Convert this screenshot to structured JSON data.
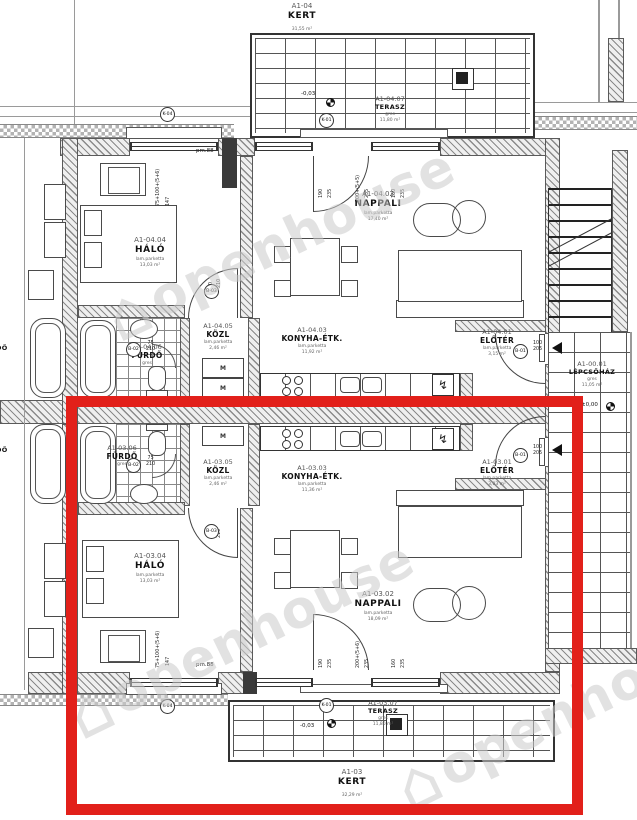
{
  "colors": {
    "highlight": "#e2201a"
  },
  "watermark": {
    "text": "openhouse",
    "logo": "⌂"
  },
  "stairwell": {
    "code": "A1-00.01",
    "name": "LÉPCSŐHÁZ",
    "finish": "gres",
    "area": "11,05 m²",
    "level": "±0,00"
  },
  "apt_top": {
    "garden": {
      "code": "A1-04",
      "name": "KERT",
      "area": "31,55 m²"
    },
    "terrace": {
      "code": "A1-04.07",
      "name": "TERASZ",
      "finish": "gres",
      "area": "11,80 m²"
    },
    "eloter": {
      "code": "A1-04.01",
      "name": "ELŐTÉR",
      "finish": "lam.parketta",
      "area": "3,15 m²"
    },
    "nappali": {
      "code": "A1-04.02",
      "name": "NAPPALI",
      "finish": "lam.parketta",
      "area": "17,40 m²"
    },
    "konyha": {
      "code": "A1-04.03",
      "name": "KONYHA-ÉTK.",
      "finish": "lam.parketta",
      "area": "11,92 m²"
    },
    "halo": {
      "code": "A1-04.04",
      "name": "HÁLÓ",
      "finish": "lam.parketta",
      "area": "13,03 m²"
    },
    "kozl": {
      "code": "A1-04.05",
      "name": "KÖZL",
      "finish": "lam.parketta",
      "area": "2,46 m²"
    },
    "furdo": {
      "code": "A1-04.06",
      "name": "FÜRDŐ",
      "finish": "gres",
      "area": "4,29 m²"
    }
  },
  "apt_bottom": {
    "garden": {
      "code": "A1-03",
      "name": "KERT",
      "area": "32,29 m²"
    },
    "terrace": {
      "code": "A1-03.07",
      "name": "TERASZ",
      "finish": "gres",
      "area": "11,80 m²"
    },
    "eloter": {
      "code": "A1-03.01",
      "name": "ELŐTÉR",
      "finish": "lam.parketta",
      "area": "3,03 m²"
    },
    "nappali": {
      "code": "A1-03.02",
      "name": "NAPPALI",
      "finish": "lam.parketta",
      "area": "18,09 m²"
    },
    "konyha": {
      "code": "A1-03.03",
      "name": "KONYHA-ÉTK.",
      "finish": "lam.parketta",
      "area": "11,36 m²"
    },
    "halo": {
      "code": "A1-03.04",
      "name": "HÁLÓ",
      "finish": "lam.parketta",
      "area": "13,03 m²"
    },
    "kozl": {
      "code": "A1-03.05",
      "name": "KÖZL",
      "finish": "lam.parketta",
      "area": "2,46 m²"
    },
    "furdo": {
      "code": "A1-03.06",
      "name": "FÜRDŐ",
      "finish": "gres",
      "area": "4,29 m²"
    }
  },
  "neighbor": {
    "furdo_name": "FÜRDŐ",
    "furdo_finish": "gres"
  },
  "tags": {
    "k01": "K-01",
    "k04": "K-04",
    "b01": "B-01",
    "b02": "B-02",
    "b03": "B-03"
  },
  "levels": {
    "terrace": "-0,03",
    "stair": "±0,00"
  },
  "dims": {
    "halo_w": "75+100+(5+6)",
    "halo_h": "147",
    "sill": "pm.88",
    "w190": "190",
    "h235": "235",
    "door_top": "200+(5+5)",
    "door_bot": "200+(5+6)",
    "w160": "160",
    "b03_w": "90",
    "b03_h": "210",
    "b02_w": "75",
    "b02_h": "210",
    "b01_w": "100",
    "b01_h": "205"
  },
  "misc": {
    "washer": "M",
    "bolt": "↯"
  }
}
